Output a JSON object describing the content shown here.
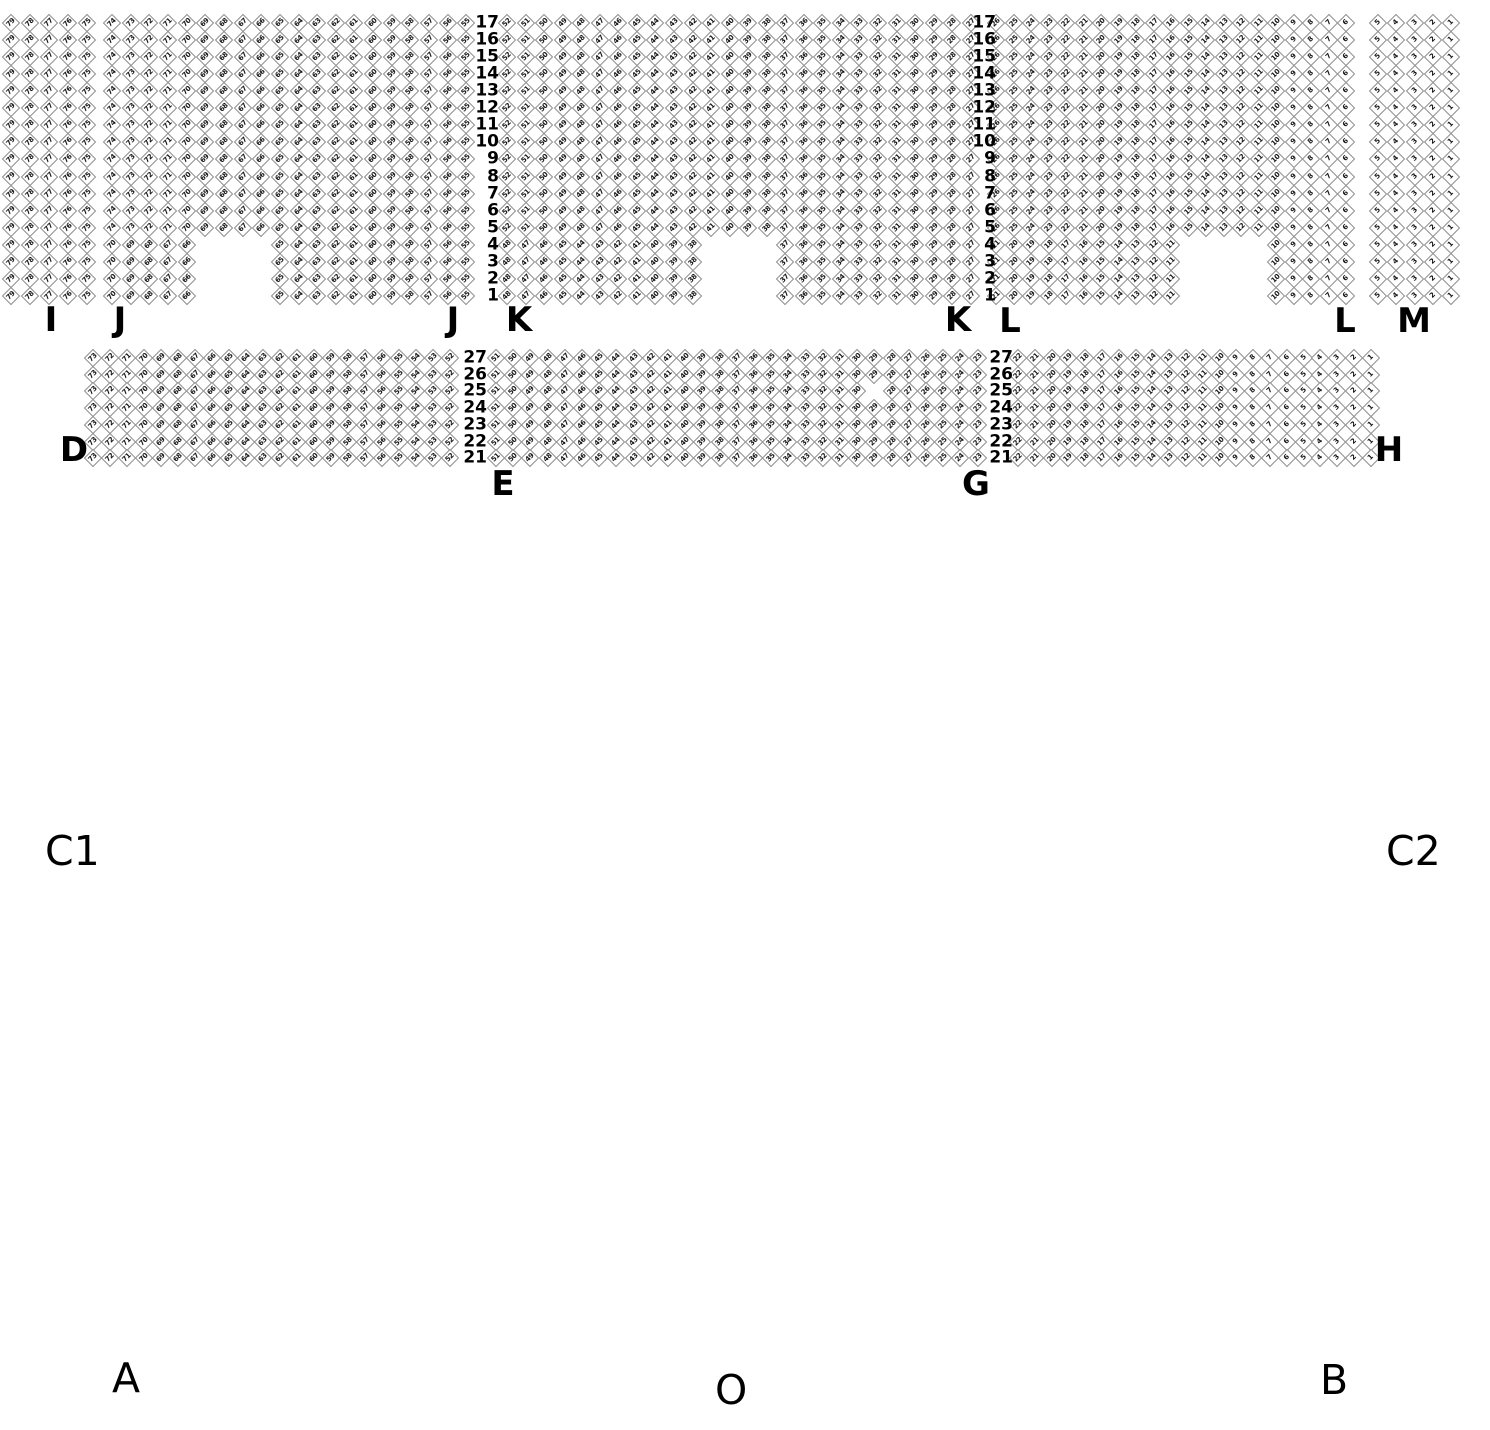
{
  "map": {
    "canvas": {
      "width": 1490,
      "height": 1430,
      "background": "#ffffff"
    },
    "seat_style": {
      "fill": "#ffffff",
      "border_color": "#8f8f8f",
      "number_color": "#161616"
    },
    "bands": [
      {
        "first_row_y": 23,
        "row_pitch": 17.06,
        "row_numbers": [
          17,
          16,
          15,
          14,
          13,
          12,
          11,
          10,
          9,
          8,
          7,
          6,
          5,
          4,
          3,
          2,
          1
        ]
      },
      {
        "first_row_y": 358,
        "row_pitch": 16.7,
        "row_numbers": [
          27,
          26,
          25,
          24,
          23,
          22,
          21
        ]
      }
    ],
    "row_label_sets": [
      {
        "band": 0,
        "right_x": 499
      },
      {
        "band": 0,
        "right_x": 996
      },
      {
        "band": 1,
        "right_x": 487
      },
      {
        "band": 1,
        "right_x": 1013
      }
    ],
    "sections": [
      {
        "id": "I",
        "band": 0,
        "x0": 11,
        "pitch": 19.0,
        "cols": 5,
        "num_end": 75
      },
      {
        "id": "J",
        "band": 0,
        "x0": 112,
        "pitch": 18.65,
        "cols": 20,
        "num_end": 55,
        "notch_rows": [
          13,
          14,
          15,
          16
        ],
        "notch_keep": [
          [
            0,
            4
          ],
          [
            9,
            19
          ]
        ]
      },
      {
        "id": "K",
        "band": 0,
        "x0": 507,
        "pitch": 18.55,
        "cols": 26,
        "num_end": 27,
        "notch_rows": [
          13,
          14,
          15,
          16
        ],
        "notch_keep": [
          [
            0,
            10
          ],
          [
            15,
            25
          ]
        ]
      },
      {
        "id": "L",
        "band": 0,
        "x0": 996,
        "pitch": 17.5,
        "cols": 21,
        "num_end": 6,
        "notch_rows": [
          13,
          14,
          15,
          16
        ],
        "notch_keep": [
          [
            0,
            10
          ],
          [
            16,
            20
          ]
        ]
      },
      {
        "id": "M",
        "band": 0,
        "x0": 1378,
        "pitch": 18.3,
        "cols": 5,
        "num_end": 1
      },
      {
        "id": "D",
        "band": 1,
        "x0": 93,
        "pitch": 17.0,
        "cols": 22,
        "num_end": 52
      },
      {
        "id": "EG",
        "band": 1,
        "x0": 496,
        "pitch": 17.2,
        "cols": 29,
        "num_end": 23,
        "holes": [
          {
            "row": 2,
            "col": 22
          }
        ]
      },
      {
        "id": "H",
        "band": 1,
        "x0": 1018,
        "pitch": 16.8,
        "cols": 22,
        "num_end": 1
      }
    ],
    "section_labels": [
      {
        "text": "I",
        "x": 51,
        "y": 320
      },
      {
        "text": "J",
        "x": 120,
        "y": 320
      },
      {
        "text": "J",
        "x": 453,
        "y": 320
      },
      {
        "text": "K",
        "x": 519,
        "y": 320
      },
      {
        "text": "K",
        "x": 958,
        "y": 320
      },
      {
        "text": "L",
        "x": 1010,
        "y": 321
      },
      {
        "text": "L",
        "x": 1345,
        "y": 321
      },
      {
        "text": "M",
        "x": 1414,
        "y": 321
      },
      {
        "text": "D",
        "x": 74,
        "y": 450
      },
      {
        "text": "E",
        "x": 503,
        "y": 484
      },
      {
        "text": "G",
        "x": 976,
        "y": 484
      },
      {
        "text": "H",
        "x": 1389,
        "y": 450
      }
    ],
    "corner_labels": {
      "c1": "C1",
      "c2": "C2",
      "a": "A",
      "o": "O",
      "b": "B"
    }
  }
}
